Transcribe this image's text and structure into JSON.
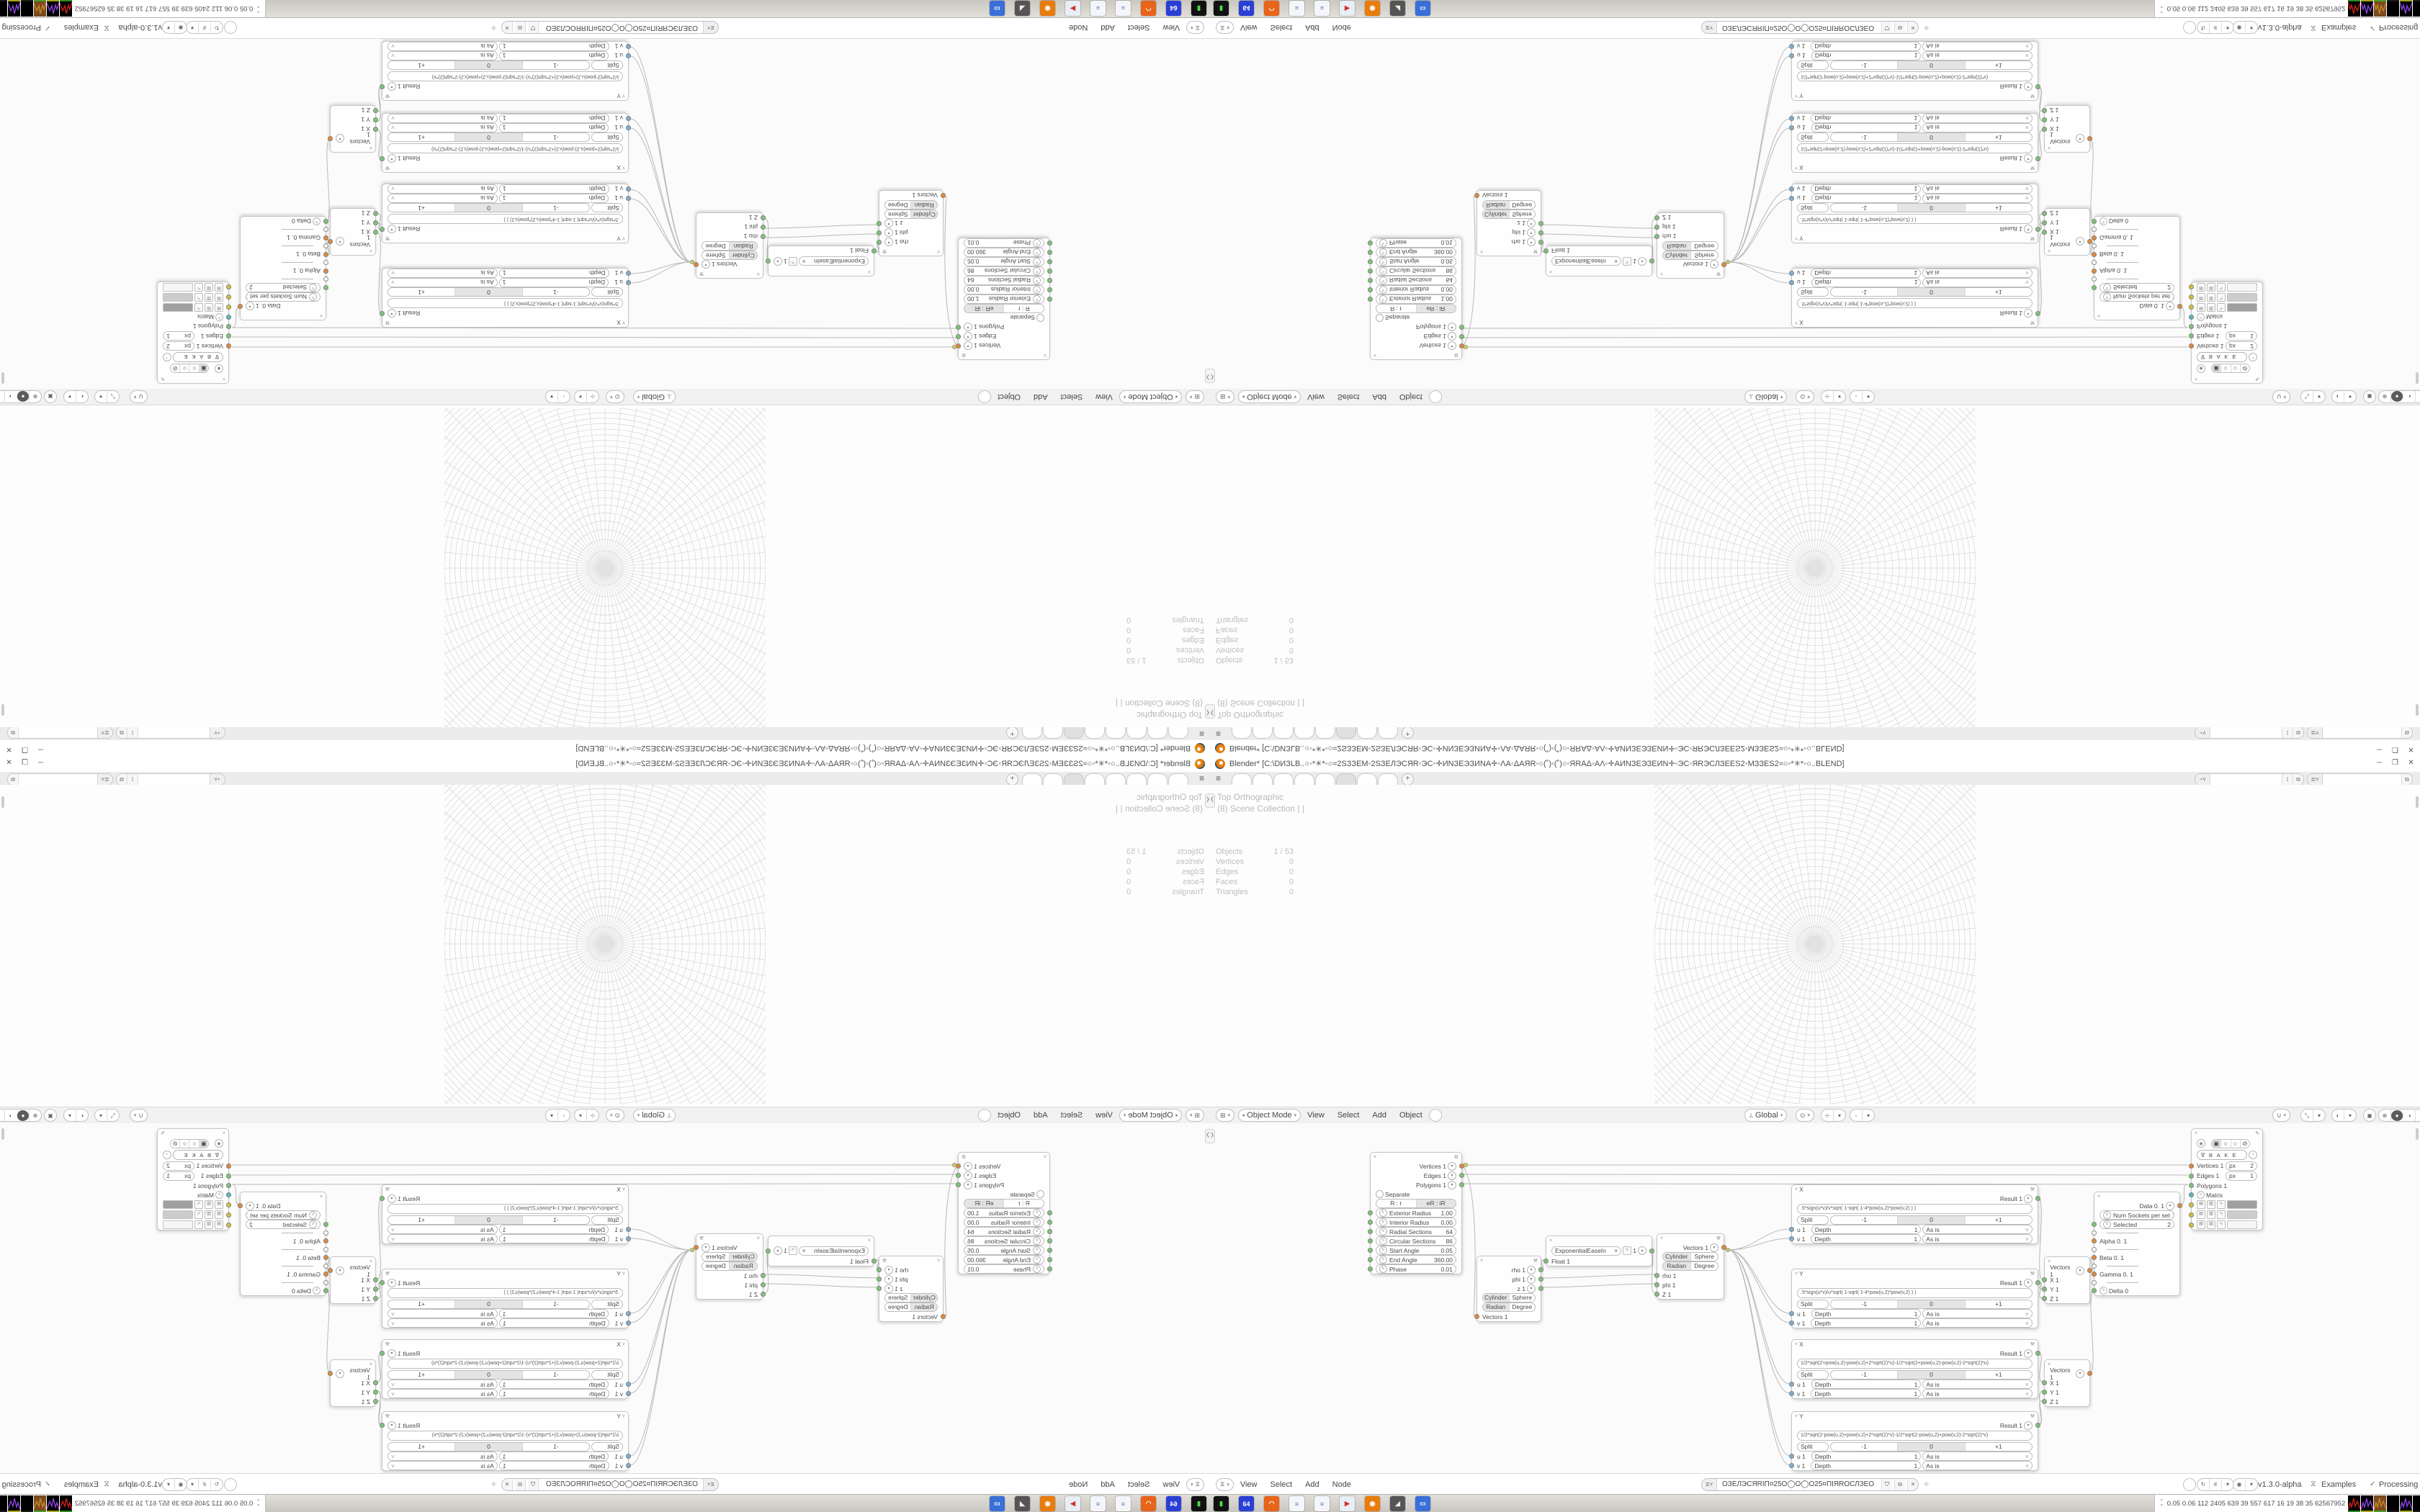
{
  "window": {
    "title": "Blender* [C:\\DИЗLB..○◦*✳*◦○≈2SЗЗEM◦2SЗЕЛЭСЯR◦ЭС◦✛ИNЗЕЭЗИNA✛◦ΛA◦ΔАЯR◦○(˚)◦(˚)○◦ЯRАΔ◦АΛ◦✛АИNЗЕЭЗЕИN✛◦ЭС◦ЯRЭСЛЗЕЕS2◦MЗЗЕS2≈○◦*✳*◦○..BLEND]",
    "controls": {
      "minimize": "─",
      "maximize": "❐",
      "close": "✕"
    }
  },
  "topbar": {
    "hamburger": "≡",
    "tab_count": 8,
    "active_tab": 5,
    "new_tab_label": "+",
    "scene_field": "",
    "view_layer_field": ""
  },
  "viewport": {
    "overlay_view": "Top Orthographic",
    "overlay_collection": "(8) Scene Collection | |",
    "stats": [
      [
        "Objects",
        "1 / 53"
      ],
      [
        "Vertices",
        "0"
      ],
      [
        "Edges",
        "0"
      ],
      [
        "Faces",
        "0"
      ],
      [
        "Triangles",
        "0"
      ]
    ],
    "header": {
      "mode": "Object Mode",
      "menus": [
        "View",
        "Select",
        "Add",
        "Object"
      ],
      "orientation": "Global"
    }
  },
  "node_editor": {
    "header": {
      "menus": [
        "View",
        "Select",
        "Add",
        "Node"
      ],
      "tree_name": "ОЗЕЛЭСЯRIП¤25О◯О◯О25¤ПIЯRОСЛЗЕО",
      "version": "v1.3.0-alpha",
      "examples_label": "Examples",
      "processing_label": "Processing",
      "processing_check": "✓"
    },
    "nodes": [
      {
        "id": "cylinder",
        "hdr": {
          "gear": true
        },
        "rows": [
          {
            "t": "out",
            "label": "Vertices 1",
            "sock": "orange"
          },
          {
            "t": "out",
            "label": "Edges 1",
            "sock": "green"
          },
          {
            "t": "out",
            "label": "Polygons 1",
            "sock": "green"
          },
          {
            "t": "toggle",
            "label": "Separate"
          },
          {
            "t": "seg",
            "segs": [
              "R : r",
              "eR : iR"
            ],
            "active": 1
          },
          {
            "t": "num",
            "label": "Exterior Radius",
            "value": "1.00",
            "sock": "green"
          },
          {
            "t": "num",
            "label": "Interior Radius",
            "value": "0.00",
            "sock": "green"
          },
          {
            "t": "num",
            "label": "Radial Sections",
            "value": "64",
            "sock": "green"
          },
          {
            "t": "num",
            "label": "Circular Sections",
            "value": "86",
            "sock": "green"
          },
          {
            "t": "num",
            "label": "Start Angle",
            "value": "0.05",
            "sock": "green"
          },
          {
            "t": "num",
            "label": "End Angle",
            "value": "360.00",
            "sock": "green"
          },
          {
            "t": "num",
            "label": "Phase",
            "value": "0.01",
            "sock": "green"
          }
        ]
      },
      {
        "id": "polar-out",
        "hdr": {
          "tool": true
        },
        "rows": [
          {
            "t": "out",
            "label": "rho 1",
            "sock": "green"
          },
          {
            "t": "out",
            "label": "phi 1",
            "sock": "green"
          },
          {
            "t": "out",
            "label": "z 1",
            "sock": "green"
          },
          {
            "t": "seg",
            "segs": [
              "Cylinder",
              "Sphere"
            ],
            "active": 0
          },
          {
            "t": "seg",
            "segs": [
              "Radian",
              "Degree"
            ],
            "active": 0
          },
          {
            "t": "in",
            "label": "Vectors 1",
            "sock": "orange"
          }
        ]
      },
      {
        "id": "easing",
        "hdr": {},
        "rows": [
          {
            "t": "easing",
            "label": "ExponentialEaseIn",
            "value": "1",
            "sock": "green"
          },
          {
            "t": "in",
            "label": "Float 1",
            "sock": "green"
          }
        ]
      },
      {
        "id": "polar-in",
        "hdr": {
          "tool": true
        },
        "rows": [
          {
            "t": "out",
            "label": "Vectors 1",
            "sock": "orange"
          },
          {
            "t": "seg",
            "segs": [
              "Cylinder",
              "Sphere"
            ],
            "active": 0
          },
          {
            "t": "seg",
            "segs": [
              "Radian",
              "Degree"
            ],
            "active": 0
          },
          {
            "t": "in",
            "label": "rho 1",
            "sock": "green"
          },
          {
            "t": "in",
            "label": "phi 1",
            "sock": "green"
          },
          {
            "t": "in",
            "label": "Z 1",
            "sock": "green"
          }
        ]
      },
      {
        "id": "formula-x1",
        "hdr": {
          "title": "X",
          "tool": true
        },
        "rows": [
          {
            "t": "out",
            "label": "Result 1",
            "sock": "green"
          },
          {
            "t": "field",
            "text": ".5*sign(u*v)/v*sqrt( 1-sqrt( 1-4*pow(u,2)*pow(v,2) ) )"
          },
          {
            "t": "split3",
            "split": "Split",
            "segs": [
              "-1",
              "0",
              "+1"
            ],
            "active": 1
          },
          {
            "t": "depthuv",
            "in": "u 1",
            "label": "Depth",
            "value": "1",
            "enum": "As is"
          },
          {
            "t": "depthuv",
            "in": "v 1",
            "label": "Depth",
            "value": "1",
            "enum": "As is"
          }
        ]
      },
      {
        "id": "formula-y1",
        "hdr": {
          "title": "Y",
          "tool": true
        },
        "rows": [
          {
            "t": "out",
            "label": "Result 1",
            "sock": "green"
          },
          {
            "t": "field",
            "text": ".5*sign(u*v)/u*sqrt( 1-sqrt( 1-4*pow(u,2)*pow(v,2) ) )"
          },
          {
            "t": "split3",
            "split": "Split",
            "segs": [
              "-1",
              "0",
              "+1"
            ],
            "active": 1
          },
          {
            "t": "depthuv",
            "in": "u 1",
            "label": "Depth",
            "value": "1",
            "enum": "As is"
          },
          {
            "t": "depthuv",
            "in": "v 1",
            "label": "Depth",
            "value": "1",
            "enum": "As is"
          }
        ]
      },
      {
        "id": "formula-x2",
        "hdr": {
          "title": "X",
          "tool": true
        },
        "rows": [
          {
            "t": "out",
            "label": "Result 1",
            "sock": "green"
          },
          {
            "t": "field",
            "text": "1/2*sqrt(2+pow(u,2)-pow(v,2)+2*sqrt(2)*u)-1/2*sqrt(2+pow(u,2)-pow(v,2)-2*sqrt(2)*u)"
          },
          {
            "t": "split3",
            "split": "Split",
            "segs": [
              "-1",
              "0",
              "+1"
            ],
            "active": 1
          },
          {
            "t": "depthuv",
            "in": "u 1",
            "label": "Depth",
            "value": "1",
            "enum": "As is"
          },
          {
            "t": "depthuv",
            "in": "v 1",
            "label": "Depth",
            "value": "1",
            "enum": "As is"
          }
        ]
      },
      {
        "id": "formula-y2",
        "hdr": {
          "title": "Y",
          "tool": true
        },
        "rows": [
          {
            "t": "out",
            "label": "Result 1",
            "sock": "green"
          },
          {
            "t": "field",
            "text": "1/2*sqrt(2-pow(u,2)+pow(v,2)+2*sqrt(2)*v)-1/2*sqrt(2-pow(u,2)+pow(v,2)-2*sqrt(2)*v)"
          },
          {
            "t": "split3",
            "split": "Split",
            "segs": [
              "-1",
              "0",
              "+1"
            ],
            "active": 1
          },
          {
            "t": "depthuv",
            "in": "u 1",
            "label": "Depth",
            "value": "1",
            "enum": "As is"
          },
          {
            "t": "depthuv",
            "in": "v 1",
            "label": "Depth",
            "value": "1",
            "enum": "As is"
          }
        ]
      },
      {
        "id": "vector-in-1",
        "hdr": {},
        "rows": [
          {
            "t": "out",
            "label": "Vectors 1",
            "sock": "orange"
          },
          {
            "t": "in",
            "label": "X 1",
            "sock": "green"
          },
          {
            "t": "in",
            "label": "Y 1",
            "sock": "green"
          },
          {
            "t": "in",
            "label": "Z 1",
            "sock": "green"
          }
        ]
      },
      {
        "id": "vector-in-2",
        "hdr": {},
        "rows": [
          {
            "t": "out",
            "label": "Vectors 1",
            "sock": "orange"
          },
          {
            "t": "in",
            "label": "X 1",
            "sock": "green"
          },
          {
            "t": "in",
            "label": "Y 1",
            "sock": "green"
          },
          {
            "t": "in",
            "label": "Z 1",
            "sock": "green"
          }
        ]
      },
      {
        "id": "data",
        "hdr": {},
        "rows": [
          {
            "t": "out",
            "label": "Data 0. 1",
            "sock": "orange"
          },
          {
            "t": "num",
            "label": "Num Sockets per set",
            "value": "1"
          },
          {
            "t": "num",
            "label": "Selected",
            "value": "2",
            "sock": "green",
            "clock": true
          },
          {
            "t": "dash"
          },
          {
            "t": "in",
            "label": "Alpha 0. 1",
            "sock": "orange"
          },
          {
            "t": "dash"
          },
          {
            "t": "in",
            "label": "Beta 0. 1",
            "sock": "orange"
          },
          {
            "t": "dash"
          },
          {
            "t": "in",
            "label": "Gamma 0. 1",
            "sock": "orange"
          },
          {
            "t": "dash"
          },
          {
            "t": "in",
            "label": "Delta 0",
            "sock": "green",
            "clock": true
          }
        ]
      },
      {
        "id": "viewer-draw",
        "hdr": {
          "pencil": true
        },
        "rows": [
          {
            "t": "vicons"
          },
          {
            "t": "bake",
            "label": "B A K E"
          },
          {
            "t": "numpx",
            "label": "Vertices 1",
            "unit": "px",
            "value": "2",
            "sock": "orange"
          },
          {
            "t": "numpx",
            "label": "Edges 1",
            "unit": "px",
            "value": "1",
            "sock": "green"
          },
          {
            "t": "in",
            "label": "Polygons 1",
            "sock": "green"
          },
          {
            "t": "in",
            "label": "Matrix",
            "sock": "cyan",
            "clock": true
          },
          {
            "t": "swatch",
            "color": "#a0a0a0"
          },
          {
            "t": "swatch",
            "color": "#cccccc"
          },
          {
            "t": "swatch",
            "color": "#f6f6f6"
          }
        ]
      }
    ]
  },
  "taskbar": {
    "expand_icon": "»",
    "numbers": "0.05 0.06 112 2405 639 39 557 617 16 19 38 35 62567952",
    "icons": [
      "terminal",
      "floppy-64",
      "firefox",
      "notepad",
      "notepad",
      "media-player",
      "blender",
      "speaker",
      "window"
    ]
  },
  "colors": {
    "accent_orange": "#e87d0d",
    "socket_green": "#7cc576",
    "socket_orange": "#e2883a",
    "socket_cyan": "#53b8c4",
    "socket_yellow": "#d4c23a",
    "grid_line": "#d6d6d6"
  }
}
